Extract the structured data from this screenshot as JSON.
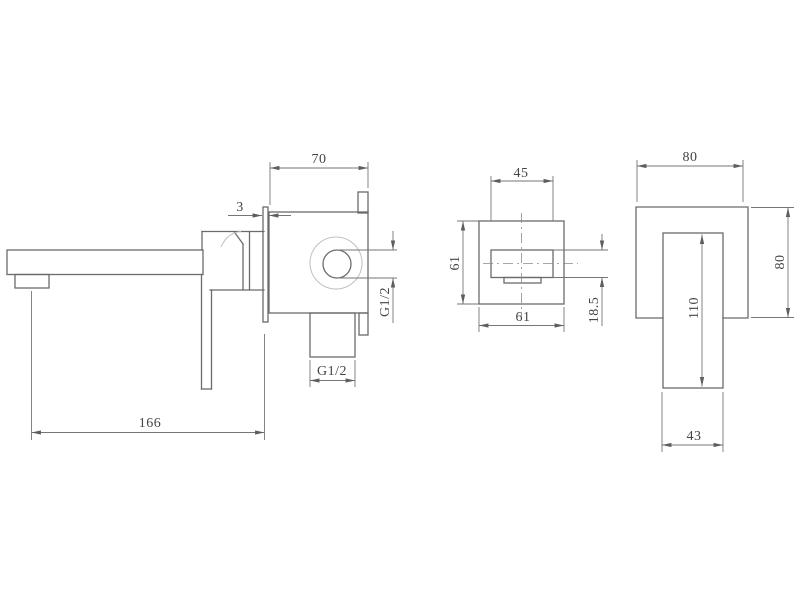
{
  "drawing": {
    "type": "technical-dimension-drawing",
    "subject": "wall-mounted basin mixer tap (three orthographic views)",
    "colors": {
      "background": "#ffffff",
      "object_line": "#6b6b6b",
      "dimension_line": "#767676",
      "light_line": "#c0c0c0",
      "text": "#454545"
    },
    "views": {
      "side": {
        "dims": {
          "body_width": "70",
          "plate_thickness": "3",
          "inlet_thread": "G1/2",
          "outlet_thread": "G1/2",
          "spout_reach": "166"
        }
      },
      "plate_front": {
        "dims": {
          "handle_width": "45",
          "plate_height": "61",
          "plate_width": "61",
          "handle_offset": "18.5"
        }
      },
      "spout_front": {
        "dims": {
          "plate_width": "80",
          "plate_height": "80",
          "spout_length": "110",
          "spout_width": "43"
        }
      }
    }
  }
}
